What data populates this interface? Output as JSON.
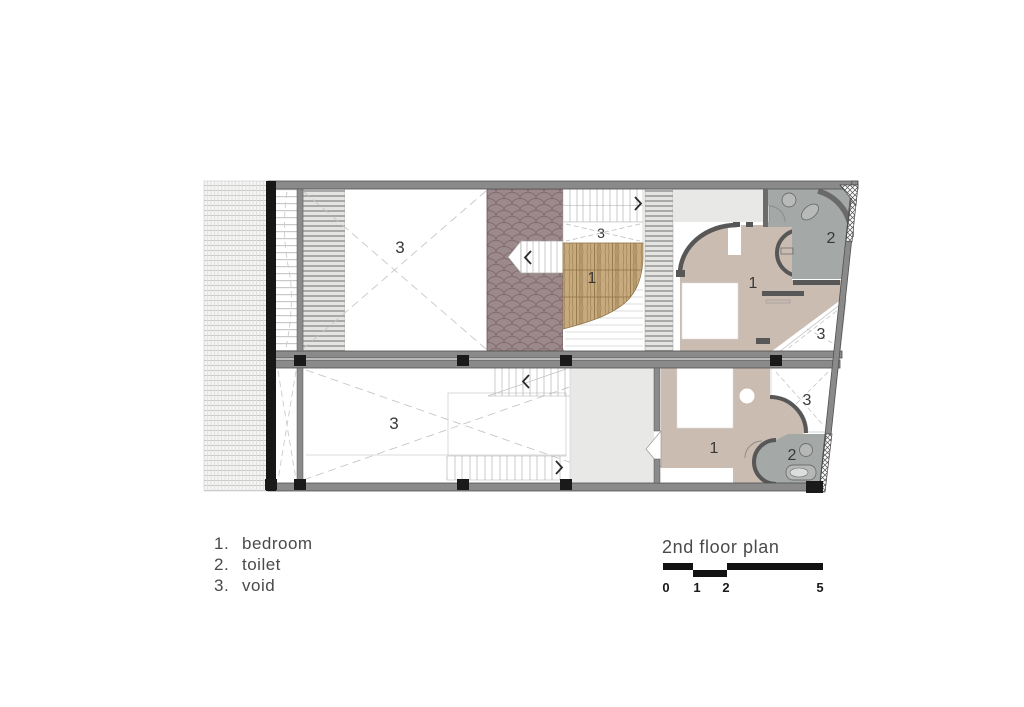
{
  "plan": {
    "room_labels": [
      {
        "name": "top-unit-main-void",
        "text": "3"
      },
      {
        "name": "top-unit-small-void",
        "text": "3"
      },
      {
        "name": "top-unit-wood-bedroom",
        "text": "1"
      },
      {
        "name": "top-unit-bedroom",
        "text": "1"
      },
      {
        "name": "top-unit-toilet",
        "text": "2"
      },
      {
        "name": "top-unit-right-void",
        "text": "3"
      },
      {
        "name": "bottom-unit-main-void",
        "text": "3"
      },
      {
        "name": "bottom-unit-bedroom",
        "text": "1"
      },
      {
        "name": "bottom-unit-toilet",
        "text": "2"
      },
      {
        "name": "bottom-unit-right-void",
        "text": "3"
      }
    ]
  },
  "legend": {
    "items": [
      {
        "number": "1.",
        "label": "bedroom"
      },
      {
        "number": "2.",
        "label": "toilet"
      },
      {
        "number": "3.",
        "label": "void"
      }
    ]
  },
  "title_block": {
    "title": "2nd floor plan",
    "scale_ticks": [
      "0",
      "1",
      "2",
      "5"
    ]
  },
  "colors": {
    "roof_tiles": "#9c898c",
    "wood_floor": "#c7ab7f",
    "bedroom_floor": "#cbbcb1",
    "toilet_floor": "#a4a8a7",
    "landing_gray": "#e8e8e7",
    "wall_gray": "#8a8a8a",
    "column_black": "#1a1a1a",
    "text_gray": "#4a4a4a"
  }
}
